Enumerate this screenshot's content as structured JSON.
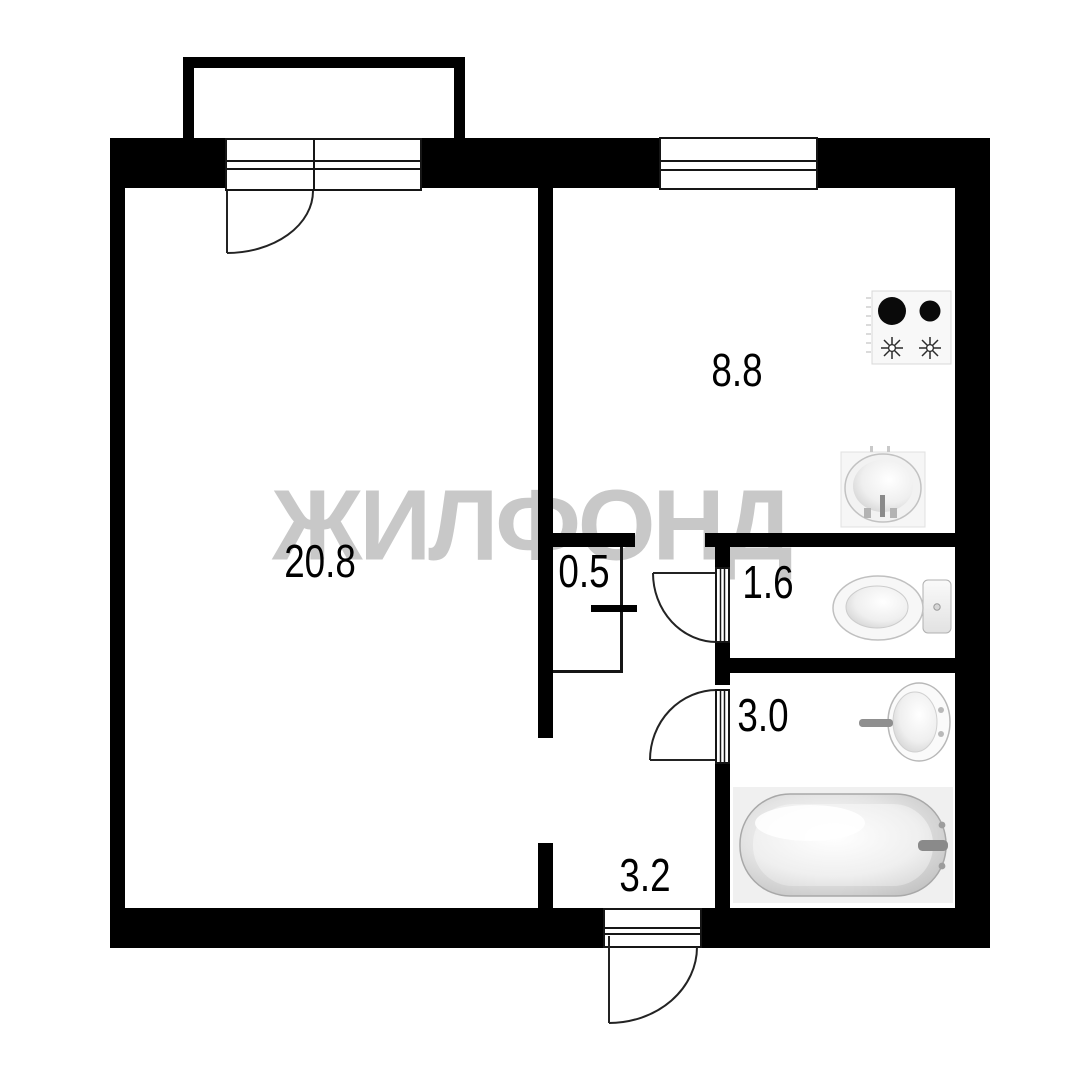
{
  "watermark": "ЖИЛФОНД",
  "rooms": [
    {
      "name": "living-room",
      "area": "20.8"
    },
    {
      "name": "kitchen",
      "area": "8.8"
    },
    {
      "name": "closet",
      "area": "0.5"
    },
    {
      "name": "wc",
      "area": "1.6"
    },
    {
      "name": "bathroom",
      "area": "3.0"
    },
    {
      "name": "hallway",
      "area": "3.2"
    }
  ],
  "fixtures": {
    "stove": "stove-icon",
    "kitchen_sink": "sink-icon",
    "toilet": "toilet-icon",
    "washbasin": "washbasin-icon",
    "bathtub": "bathtub-icon"
  },
  "colors": {
    "wall": "#000000",
    "line": "#161616",
    "watermark": "#c8c8c8",
    "background": "#ffffff",
    "fixture_fill": "#f7f7f7",
    "fixture_stroke": "#b5b5b5"
  }
}
